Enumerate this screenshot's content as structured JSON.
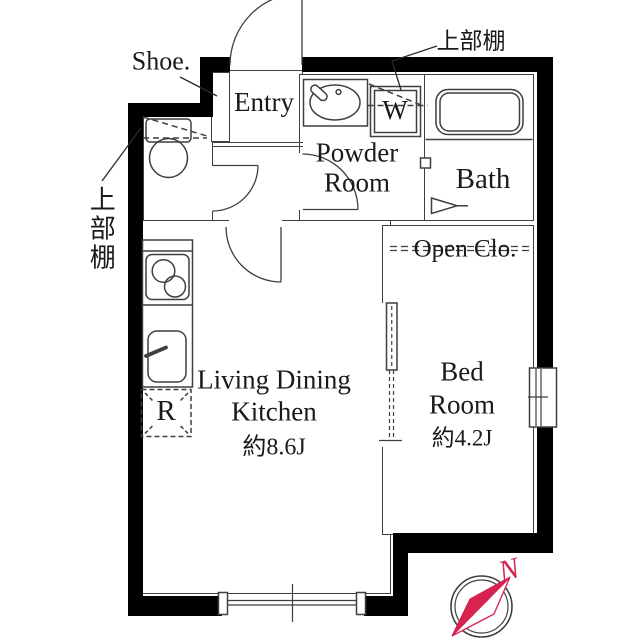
{
  "floorplan": {
    "type": "apartment-floor-plan",
    "colors": {
      "wall": "#000000",
      "line": "#3f3f3f",
      "leader": "#2a2a2a",
      "accent": "#d6234f"
    },
    "labels": {
      "shoe": "Shoe.",
      "shelf_top": "上部棚",
      "shelf_left": "上部棚",
      "entry": "Entry",
      "powder_1": "Powder",
      "powder_2": "Room",
      "washer": "W",
      "bath": "Bath",
      "open_closet": "Open Clo.",
      "ldk_1": "Living Dining",
      "ldk_2": "Kitchen",
      "ldk_size": "約8.6J",
      "bed_1": "Bed",
      "bed_2": "Room",
      "bed_size": "約4.2J",
      "fridge": "R",
      "compass_north": "N"
    }
  }
}
